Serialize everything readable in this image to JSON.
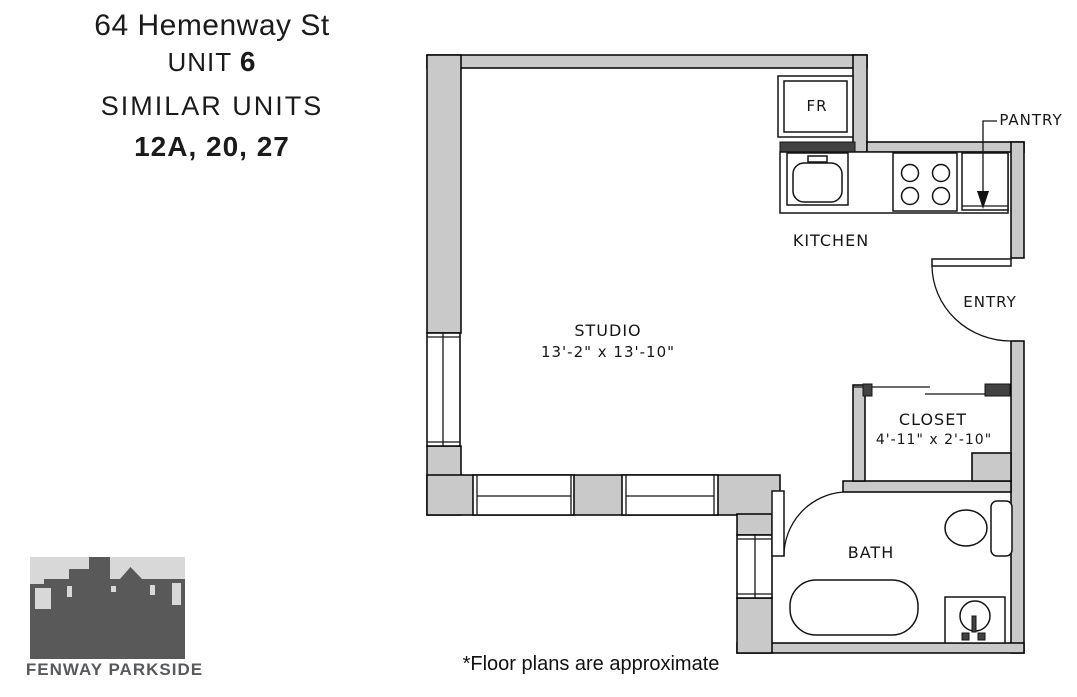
{
  "header": {
    "address": "64 Hemenway St",
    "unit_label": "UNIT",
    "unit_number": "6",
    "similar_label": "SIMILAR UNITS",
    "similar_units": "12A, 20, 27"
  },
  "plan": {
    "rooms": {
      "studio": {
        "name": "STUDIO",
        "dims": "13'-2\" x 13'-10\""
      },
      "kitchen": {
        "name": "KITCHEN"
      },
      "closet": {
        "name": "CLOSET",
        "dims": "4'-11\" x 2'-10\""
      },
      "bath": {
        "name": "BATH"
      },
      "entry": {
        "name": "ENTRY"
      },
      "pantry": {
        "name": "PANTRY"
      },
      "fridge": {
        "name": "FR"
      }
    }
  },
  "footer": {
    "note": "*Floor plans are approximate"
  },
  "logo": {
    "caption": "FENWAY PARKSIDE"
  },
  "colors": {
    "wall_fill": "#c9c9c9",
    "dark_fill": "#424242",
    "logo_sky": "#d8d8d8",
    "logo_building": "#595959"
  }
}
